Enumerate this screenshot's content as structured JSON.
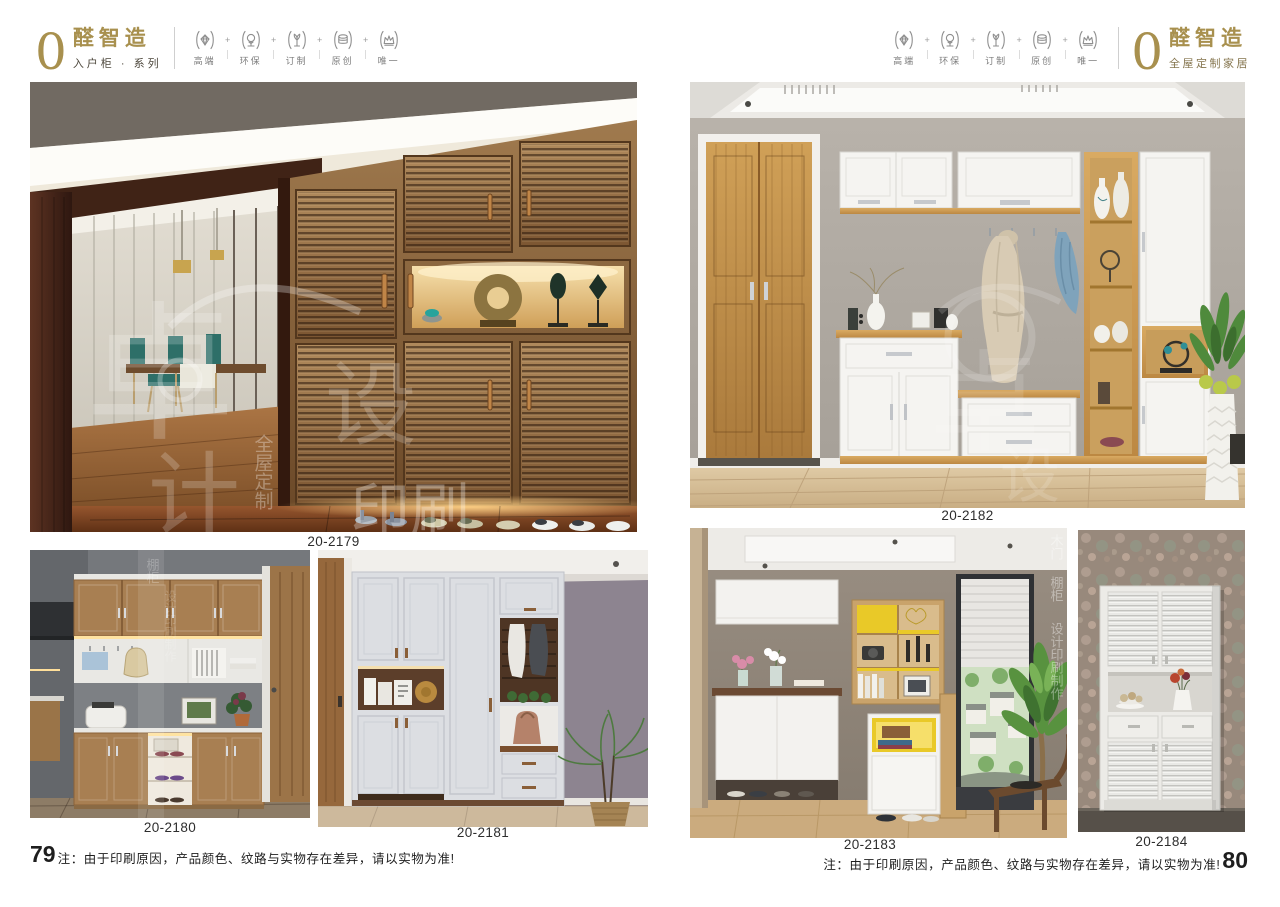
{
  "header_left": {
    "zero": "0",
    "brand": "醛智造",
    "series": "入户柜 · 系列"
  },
  "header_right": {
    "zero": "0",
    "brand": "醛智造",
    "tagline": "全屋定制家居"
  },
  "badges": [
    {
      "label": "高端",
      "icon": "diamond-icon"
    },
    {
      "label": "环保",
      "icon": "tree-icon"
    },
    {
      "label": "订制",
      "icon": "sprout-icon"
    },
    {
      "label": "原创",
      "icon": "coins-icon"
    },
    {
      "label": "唯一",
      "icon": "crown-icon"
    }
  ],
  "misc": {
    "plus": "+"
  },
  "products": [
    {
      "code": "20-2179"
    },
    {
      "code": "20-2180"
    },
    {
      "code": "20-2181"
    },
    {
      "code": "20-2182"
    },
    {
      "code": "20-2183"
    },
    {
      "code": "20-2184"
    }
  ],
  "footer": {
    "left_page": "79",
    "right_page": "80",
    "note": "注：由于印刷原因，产品颜色、纹路与实物存在差异，请以实物为准!"
  },
  "watermarks": {
    "c1": "卓",
    "c2": "设",
    "c3": "计",
    "print": "印刷",
    "whole": "全屋定制",
    "side1": "木门",
    "side2": "棚柜",
    "side3": "设计印刷制作"
  },
  "colors": {
    "brand_gold": "#a8904e",
    "accent_yellow": "#e9c928",
    "wood_oak": "#c89a58",
    "badge_gray": "#8f8f8f"
  }
}
